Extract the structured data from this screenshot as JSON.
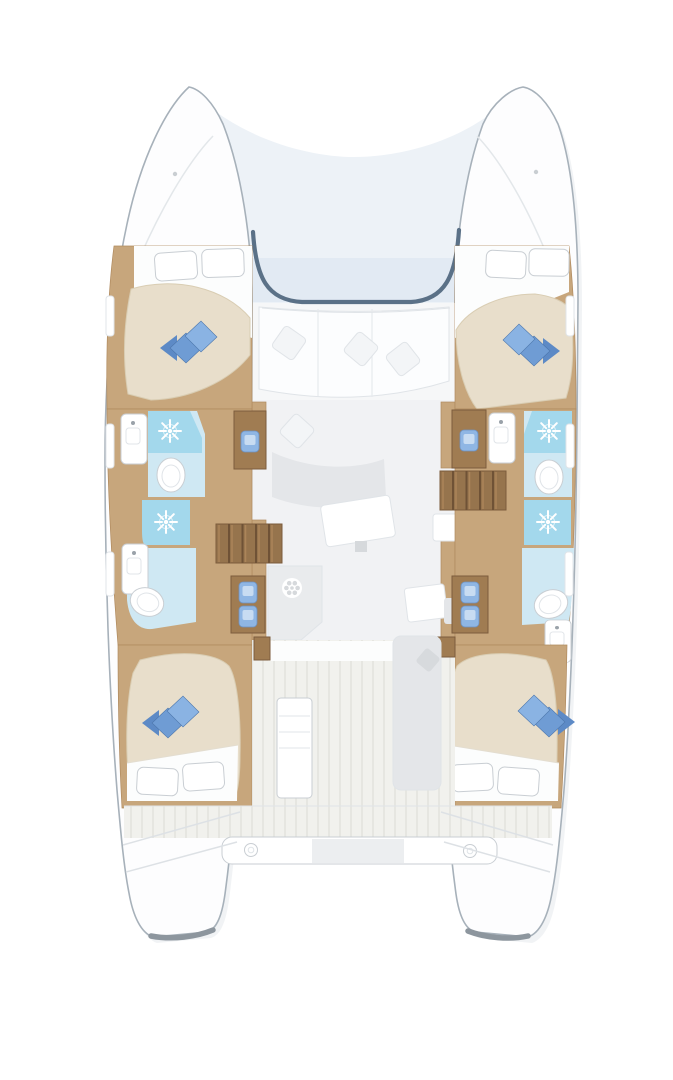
{
  "figure": {
    "type": "deck-plan",
    "subject": "catamaran yacht interior layout, top view, bows up",
    "visible_counts": {
      "hulls": 2,
      "double_beds": 4,
      "shower_symbols": 4,
      "toilets": 4,
      "sinks": 4,
      "staircases": 2,
      "desk_seats": 6
    }
  },
  "icons": [
    "shower-icon",
    "toilet-icon",
    "sink-icon",
    "stove-burner-icon",
    "stairs-icon",
    "pillow-icon",
    "cleat-icon",
    "windshield-line"
  ],
  "colors": {
    "background": "#ffffff",
    "hull": "#fdfdfe",
    "hull_shadow": "#ccd4da",
    "glass": "#edf2f7",
    "glass_deep": "#dfe9f2",
    "windshield": "#5b7187",
    "deck_band": "#f6f7f8",
    "sofa": "#fcfdfe",
    "cushion": "#f3f5f7",
    "saloon_floor": "#f1f2f4",
    "furniture_gray": "#e4e6e9",
    "table_white": "#ffffff",
    "counter_gray": "#e9ebed",
    "burner_gray": "#d6d9dc",
    "napkin_gray": "#d7dadd",
    "wood": "#c7a67c",
    "wood_dark": "#a07c52",
    "stair_wood": "#96744d",
    "stair_gap": "#6f5236",
    "bed": "#e8decb",
    "sheet": "#fcfdfd",
    "pillow_white": "#ffffff",
    "pillow_blue": "#6f9cd4",
    "pillow_blue_light": "#8ab3e3",
    "pillow_blue_dark": "#5d8ac6",
    "bath_floor": "#cfe8f3",
    "shower_floor": "#a3d8ec",
    "porcelain": "#ffffff",
    "chair_blue": "#8fb6e4",
    "chair_blue_light": "#c8dcf2",
    "teak": "#f1f1ed",
    "teak_line": "#e3e3de",
    "beam_gray": "#eceef0",
    "transom_edge": "#8d969e",
    "cleat_gray": "#c9ced2"
  }
}
